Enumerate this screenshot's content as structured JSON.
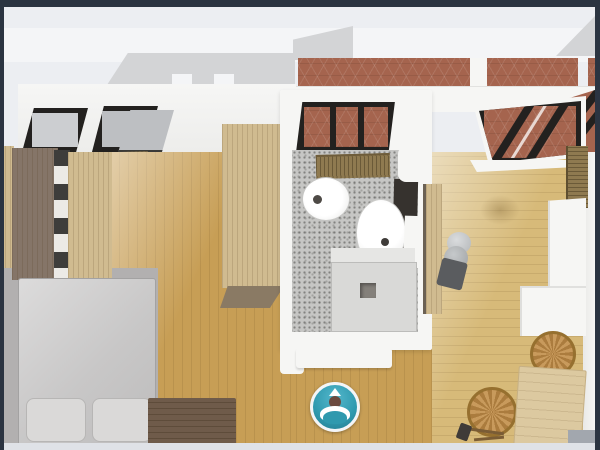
{
  "scene": {
    "description": "3D top-down dollhouse view of a studio apartment floor plan with bedroom, bathroom and kitchen-living room, terracotta tiled terrace along the top",
    "colors": {
      "navy": "#2b3441",
      "bg": "#eceef2",
      "band": "#f4f5f7",
      "wall": "#f6f6f4",
      "roof": "#d3d4d6",
      "glass": "#ccced1",
      "tile": "#a5644e",
      "frame": "#23211f",
      "woodl": "#c79e55",
      "woodr": "#d7ba79",
      "woodlight": "#d0bb90",
      "wooddark": "#6f5b4a",
      "wardrobe": "#857568",
      "carpet": "#b2b0b0",
      "bed": "#c8c7c7",
      "pillow": "#dad9d8",
      "bathfloor": "#c6c6c4",
      "shower": "#d9d9d7",
      "radiator": "#8f7a50",
      "vanity": "#36322e",
      "boiler": "#b3b6b8",
      "wicker": "#bf9050",
      "table": "#dcc9a0",
      "teal": "#2f99ae",
      "head": "#6b4a3f",
      "patch": "#a2a7ae",
      "strip": "#dfe2e7"
    },
    "objects": {
      "scene": "apartment-3d-floorplan",
      "roof": "roof",
      "terrace": "terracotta-tiled-terrace",
      "skylight": "skylight-window",
      "bed": "double-bed",
      "pillow": "pillow",
      "bench": "bed-end-bench",
      "wardrobe": "wardrobe",
      "cabinet": "tall-cabinet",
      "carpet": "area-rug",
      "radiator": "radiator",
      "bathroom": "bathroom",
      "bidet": "bidet",
      "basin": "washbasin",
      "vanity": "vanity-mirror-unit",
      "shower": "shower-tray",
      "window": "bathroom-window",
      "balcony_door": "glass-balcony-door",
      "boiler": "water-heater",
      "counter": "kitchen-counter",
      "chair": "wicker-chair",
      "table": "dining-table",
      "marker": "360-viewpoint-marker"
    },
    "marker": {
      "name": "360-viewpoint-marker",
      "glyph": "person-figure-in-circle"
    }
  }
}
